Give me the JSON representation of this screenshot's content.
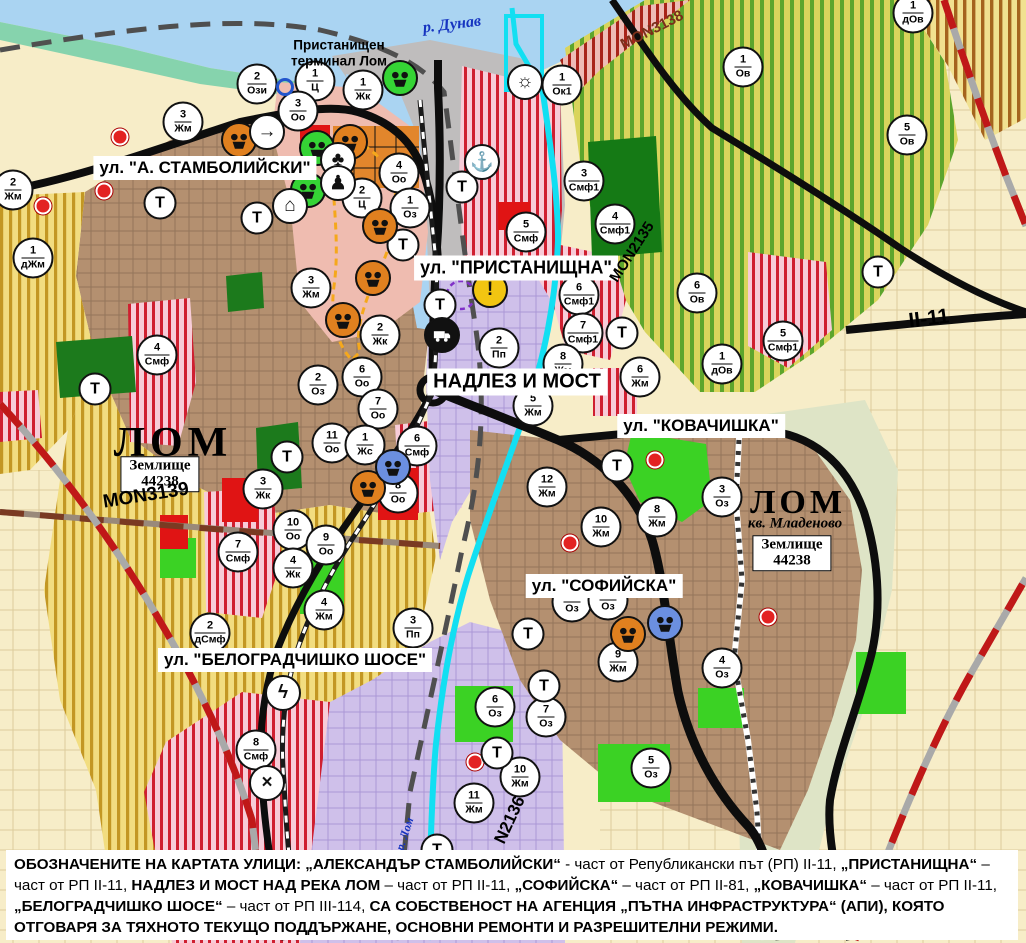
{
  "map": {
    "river_label": "р. Дунав",
    "river_lom_label": "р. Лом",
    "port_terminal_label": "Пристанищен терминал Лом",
    "city_label_west": "ЛОМ",
    "city_label_east": "ЛОМ",
    "district_label_east": "кв. Младеново",
    "land_area_west": {
      "line1": "Землище",
      "line2": "44238"
    },
    "land_area_east": {
      "line1": "Землище",
      "line2": "44238"
    },
    "street_labels": {
      "stambolijski": "ул. \"А. СТАМБОЛИЙСКИ\"",
      "pristanishtna": "ул. \"ПРИСТАНИЩНА\"",
      "nadlez": "НАДЛЕЗ И МОСТ",
      "kovachishka": "ул. \"КОВАЧИШКА\"",
      "sofijska": "ул. \"СОФИЙСКА\"",
      "belogradchishko": "ул. \"БЕЛОГРАДЧИШКО ШОСЕ\""
    },
    "road_labels": {
      "mon3138": "MON3138",
      "mon2135": "MON2135",
      "ii11": "II-11",
      "mon3139": "MON3139",
      "n2136": "N2136"
    },
    "transport_marker_label": "Т",
    "zone_markers": [
      [
        "2",
        "Ози",
        257,
        84
      ],
      [
        "1",
        "Ц",
        315,
        81
      ],
      [
        "1",
        "Жк",
        363,
        90
      ],
      [
        "3",
        "Оо",
        298,
        111
      ],
      [
        "3",
        "Жм",
        183,
        122
      ],
      [
        "2",
        "Жм",
        13,
        190
      ],
      [
        "1",
        "дЖм",
        33,
        258
      ],
      [
        "4",
        "Оо",
        399,
        173
      ],
      [
        "2",
        "Ц",
        362,
        198
      ],
      [
        "1",
        "Оз",
        410,
        208
      ],
      [
        "3",
        "Жм",
        311,
        288
      ],
      [
        "1",
        "Ок1",
        562,
        85
      ],
      [
        "3",
        "Смф1",
        584,
        181
      ],
      [
        "4",
        "Смф1",
        615,
        224
      ],
      [
        "5",
        "Смф",
        526,
        232
      ],
      [
        "6",
        "Смф1",
        579,
        295
      ],
      [
        "7",
        "Смф1",
        583,
        333
      ],
      [
        "2",
        "Пп",
        499,
        348
      ],
      [
        "2",
        "Жк",
        380,
        335
      ],
      [
        "6",
        "Оо",
        362,
        377
      ],
      [
        "7",
        "Оо",
        378,
        409
      ],
      [
        "2",
        "Оз",
        318,
        385
      ],
      [
        "11",
        "Оо",
        332,
        443
      ],
      [
        "1",
        "Жс",
        365,
        445
      ],
      [
        "6",
        "Смф",
        417,
        446
      ],
      [
        "8",
        "Оо",
        398,
        493
      ],
      [
        "3",
        "Жк",
        263,
        489
      ],
      [
        "10",
        "Оо",
        293,
        530
      ],
      [
        "9",
        "Оо",
        326,
        545
      ],
      [
        "4",
        "Жк",
        293,
        568
      ],
      [
        "4",
        "Жм",
        324,
        610
      ],
      [
        "7",
        "Смф",
        238,
        552
      ],
      [
        "2",
        "дСмф",
        210,
        633
      ],
      [
        "4",
        "Смф",
        157,
        355
      ],
      [
        "8",
        "Смф",
        256,
        750
      ],
      [
        "3",
        "Пп",
        413,
        628
      ],
      [
        "1",
        "Ов",
        743,
        67
      ],
      [
        "5",
        "Ов",
        907,
        135
      ],
      [
        "1",
        "дОв",
        913,
        13
      ],
      [
        "6",
        "Ов",
        697,
        293
      ],
      [
        "5",
        "Смф1",
        783,
        341
      ],
      [
        "1",
        "дОв",
        722,
        364
      ],
      [
        "8",
        "Жм",
        563,
        364
      ],
      [
        "5",
        "Жм",
        533,
        406
      ],
      [
        "6",
        "Жм",
        640,
        377
      ],
      [
        "12",
        "Жм",
        547,
        487
      ],
      [
        "10",
        "Жм",
        601,
        527
      ],
      [
        "8",
        "Жм",
        657,
        517
      ],
      [
        "3",
        "Оз",
        722,
        497
      ],
      [
        "9",
        "Жм",
        618,
        662
      ],
      [
        "4",
        "Оз",
        722,
        668
      ],
      [
        "6",
        "Оз",
        495,
        707
      ],
      [
        "7",
        "Оз",
        546,
        717
      ],
      [
        "5",
        "Оз",
        651,
        768
      ],
      [
        "10",
        "Жм",
        520,
        777
      ],
      [
        "11",
        "Жм",
        474,
        803
      ],
      [
        "",
        "Оз",
        572,
        602
      ],
      [
        "",
        "Оз",
        608,
        600
      ]
    ],
    "transport_markers": [
      [
        160,
        203
      ],
      [
        257,
        218
      ],
      [
        95,
        389
      ],
      [
        287,
        457
      ],
      [
        403,
        245
      ],
      [
        440,
        305
      ],
      [
        462,
        187
      ],
      [
        622,
        333
      ],
      [
        878,
        272
      ],
      [
        617,
        466
      ],
      [
        528,
        634
      ],
      [
        544,
        686
      ],
      [
        497,
        753
      ],
      [
        437,
        850
      ]
    ],
    "icon_markers": [
      {
        "name": "monument-orange-icon",
        "x": 239,
        "y": 140,
        "bg": "#e0801f",
        "glyph": ""
      },
      {
        "name": "monument-orange-icon",
        "x": 350,
        "y": 142,
        "bg": "#e0801f",
        "glyph": ""
      },
      {
        "name": "monument-orange-icon",
        "x": 380,
        "y": 226,
        "bg": "#e0801f",
        "glyph": ""
      },
      {
        "name": "monument-orange-icon",
        "x": 373,
        "y": 278,
        "bg": "#e0801f",
        "glyph": ""
      },
      {
        "name": "monument-orange-icon",
        "x": 343,
        "y": 320,
        "bg": "#e0801f",
        "glyph": ""
      },
      {
        "name": "monument-orange-icon",
        "x": 368,
        "y": 488,
        "bg": "#e0801f",
        "glyph": ""
      },
      {
        "name": "monument-orange-icon",
        "x": 628,
        "y": 634,
        "bg": "#e0801f",
        "glyph": ""
      },
      {
        "name": "monument-green-icon",
        "x": 400,
        "y": 78,
        "bg": "#35d435",
        "glyph": ""
      },
      {
        "name": "monument-green-icon",
        "x": 317,
        "y": 148,
        "bg": "#35d435",
        "glyph": ""
      },
      {
        "name": "monument-green-icon",
        "x": 308,
        "y": 190,
        "bg": "#35d435",
        "glyph": ""
      },
      {
        "name": "monument-blue-icon",
        "x": 393,
        "y": 467,
        "bg": "#6b8fe0",
        "glyph": ""
      },
      {
        "name": "monument-blue-icon",
        "x": 665,
        "y": 623,
        "bg": "#6b8fe0",
        "glyph": ""
      },
      {
        "name": "arrow-icon",
        "x": 267,
        "y": 132,
        "bg": "#ffffff",
        "glyph": "→"
      },
      {
        "name": "clover-icon",
        "x": 338,
        "y": 160,
        "bg": "#ffffff",
        "glyph": "♣"
      },
      {
        "name": "people-icon",
        "x": 338,
        "y": 183,
        "bg": "#ffffff",
        "glyph": "♟"
      },
      {
        "name": "tunnel-icon",
        "x": 290,
        "y": 206,
        "bg": "#ffffff",
        "glyph": "⌂"
      },
      {
        "name": "anchor-icon",
        "x": 482,
        "y": 162,
        "bg": "#ffffff",
        "glyph": "⚓"
      },
      {
        "name": "sun-icon",
        "x": 525,
        "y": 82,
        "bg": "#ffffff",
        "glyph": "☼"
      },
      {
        "name": "warning-icon",
        "x": 490,
        "y": 290,
        "bg": "#f2c511",
        "glyph": "!"
      },
      {
        "name": "truck-icon",
        "x": 442,
        "y": 335,
        "bg": "#111111",
        "glyph": ""
      },
      {
        "name": "lightning-icon",
        "x": 283,
        "y": 693,
        "bg": "#ffffff",
        "glyph": "ϟ"
      },
      {
        "name": "rail-crossing-icon",
        "x": 267,
        "y": 783,
        "bg": "#ffffff",
        "glyph": "×"
      },
      {
        "name": "ring-icon",
        "x": 285,
        "y": 87,
        "bg": "",
        "glyph": "",
        "ring": "#2255cc"
      }
    ],
    "red_dots": [
      [
        120,
        137
      ],
      [
        104,
        191
      ],
      [
        43,
        206
      ],
      [
        655,
        460
      ],
      [
        570,
        543
      ],
      [
        475,
        762
      ],
      [
        768,
        617
      ]
    ],
    "colors": {
      "water": "#aad4f2",
      "river_lom": "#12dff2",
      "urban": "#b49070",
      "smf_stripe": "#cf1f30",
      "agri_stripe": "#b8860b",
      "vineyard_stripe": "#5da52c",
      "park": "#1c7a1c",
      "green_zone": "#3bd224",
      "industry": "#cfc0ea",
      "road": "#0d0d0d",
      "route_dashed": "#c01818"
    }
  },
  "footer": {
    "segments": [
      {
        "text": "ОБОЗНАЧЕНИТЕ НА КАРТАТА УЛИЦИ: „АЛЕКСАНДЪР СТАМБОЛИЙСКИ“",
        "bold": true
      },
      {
        "text": " - част от Републикански път (РП) II-11, ",
        "bold": false
      },
      {
        "text": "„ПРИСТАНИЩНА“",
        "bold": true
      },
      {
        "text": " – част от РП II-11, ",
        "bold": false
      },
      {
        "text": "НАДЛЕЗ И МОСТ НАД РЕКА ЛОМ",
        "bold": true
      },
      {
        "text": " – част от РП II-11, ",
        "bold": false
      },
      {
        "text": "„СОФИЙСКА“",
        "bold": true
      },
      {
        "text": " – част от РП II-81, ",
        "bold": false
      },
      {
        "text": "„КОВАЧИШКА“",
        "bold": true
      },
      {
        "text": " – част от РП II-11, ",
        "bold": false
      },
      {
        "text": "„БЕЛОГРАДЧИШКО ШОСЕ“",
        "bold": true
      },
      {
        "text": " – част от РП III-114, ",
        "bold": false
      },
      {
        "text": "СА СОБСТВЕНОСТ НА АГЕНЦИЯ „ПЪТНА ИНФРАСТРУКТУРА“ (АПИ), КОЯТО ОТГОВАРЯ ЗА ТЯХНОТО ТЕКУЩО ПОДДЪРЖАНЕ, ОСНОВНИ РЕМОНТИ И РАЗРЕШИТЕЛНИ РЕЖИМИ.",
        "bold": true
      }
    ]
  }
}
